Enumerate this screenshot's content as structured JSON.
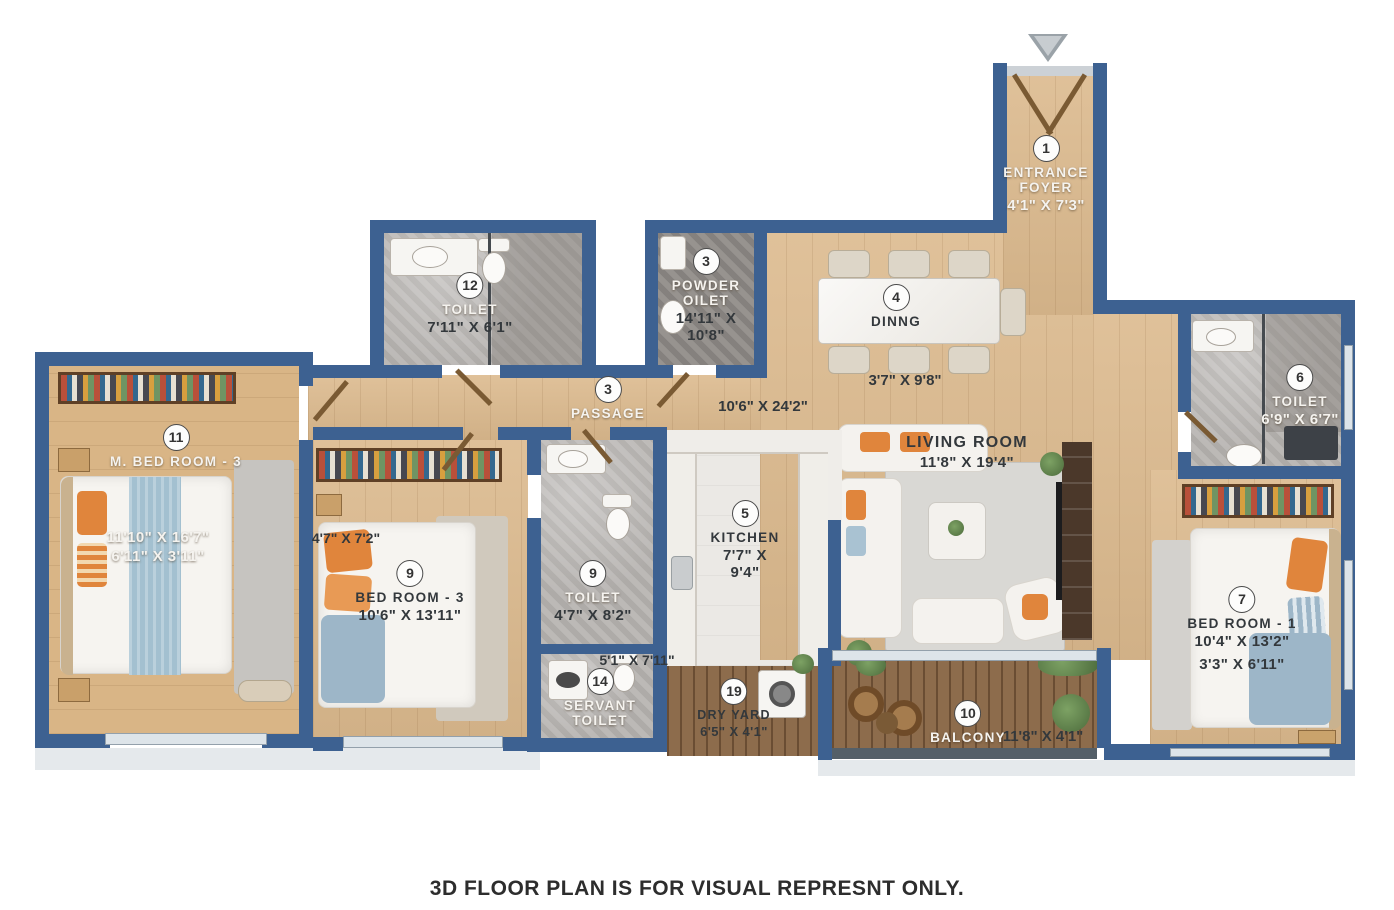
{
  "page": {
    "footer": "3D FLOOR PLAN IS FOR VISUAL REPRESNT ONLY."
  },
  "colors": {
    "wall": "#3d6191",
    "floor_wood": "#dcba8e",
    "deck_wood": "#8d6c4c",
    "marble": "#b7b4b1",
    "accent_orange": "#e0853c",
    "blanket_blue": "#9db6c8"
  },
  "rooms": {
    "entrance_foyer": {
      "number": "1",
      "name": "ENTRANCE FOYER",
      "dims": "4'1\" X 7'3\""
    },
    "toilet_12": {
      "number": "12",
      "name": "TOILET",
      "dims": "7'11\" X 6'1\""
    },
    "powder_toilet": {
      "number": "3",
      "name": "POWDER OILET",
      "dims": "14'11\" X 10'8\""
    },
    "dining": {
      "number": "4",
      "name": "DINNG",
      "dims": "3'7\" X 9'8\""
    },
    "passage": {
      "number": "3",
      "name": "PASSAGE",
      "dims": "10'6\" X 24'2\""
    },
    "living_room": {
      "name": "LIVING ROOM",
      "dims": "11'8\" X 19'4\""
    },
    "toilet_6": {
      "number": "6",
      "name": "TOILET",
      "dims": "6'9\" X 6'7\""
    },
    "m_bed_room_3": {
      "number": "11",
      "name": "M. BED ROOM - 3",
      "dims": "11'10\" X 16'7\"",
      "dims2": "6'11\" X 3'11\""
    },
    "bed_room_3": {
      "number": "9",
      "name": "BED ROOM - 3",
      "dims": "10'6\" X 13'11\"",
      "dims2": "4'7\" X 7'2\""
    },
    "toilet_9": {
      "number": "9",
      "name": "TOILET",
      "dims": "4'7\" X 8'2\""
    },
    "kitchen": {
      "number": "5",
      "name": "KITCHEN",
      "dims": "7'7\" X 9'4\""
    },
    "servant_toilet": {
      "number": "14",
      "name": "SERVANT TOILET",
      "dims": "5'1\" X 7'11\""
    },
    "dry_yard": {
      "number": "19",
      "name": "DRY YARD",
      "dims": "6'5\" X 4'1\""
    },
    "balcony": {
      "number": "10",
      "name": "BALCONY",
      "dims": "11'8\" X 4'1\""
    },
    "bed_room_1": {
      "number": "7",
      "name": "BED ROOM - 1",
      "dims": "10'4\" X 13'2\"",
      "dims2": "3'3\" X 6'11\""
    }
  }
}
